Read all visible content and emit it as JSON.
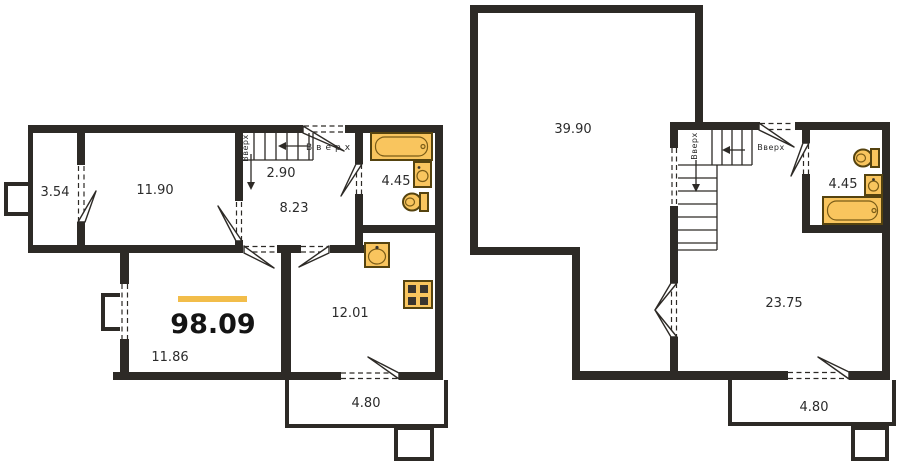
{
  "colors": {
    "wall": "#2d2a26",
    "fixture_fill": "#f9c55e",
    "fixture_stroke": "#55430f",
    "accent_bar": "#f2bd4a",
    "text": "#2b2b2b"
  },
  "floor1": {
    "total_area": "98.09",
    "rooms": {
      "loggia": "3.54",
      "bedroom": "11.90",
      "stairs": "2.90",
      "hall": "8.23",
      "bathroom": "4.45",
      "kitchen": "12.01",
      "living": "11.86",
      "balcony": "4.80"
    },
    "stairs_up_vertical": "Вверх",
    "entry_up": "Вверх"
  },
  "floor2": {
    "rooms": {
      "big_room": "39.90",
      "bathroom": "4.45",
      "room": "23.75",
      "balcony": "4.80"
    },
    "stairs_up_vertical": "Вверх",
    "door_up": "Вверх"
  }
}
